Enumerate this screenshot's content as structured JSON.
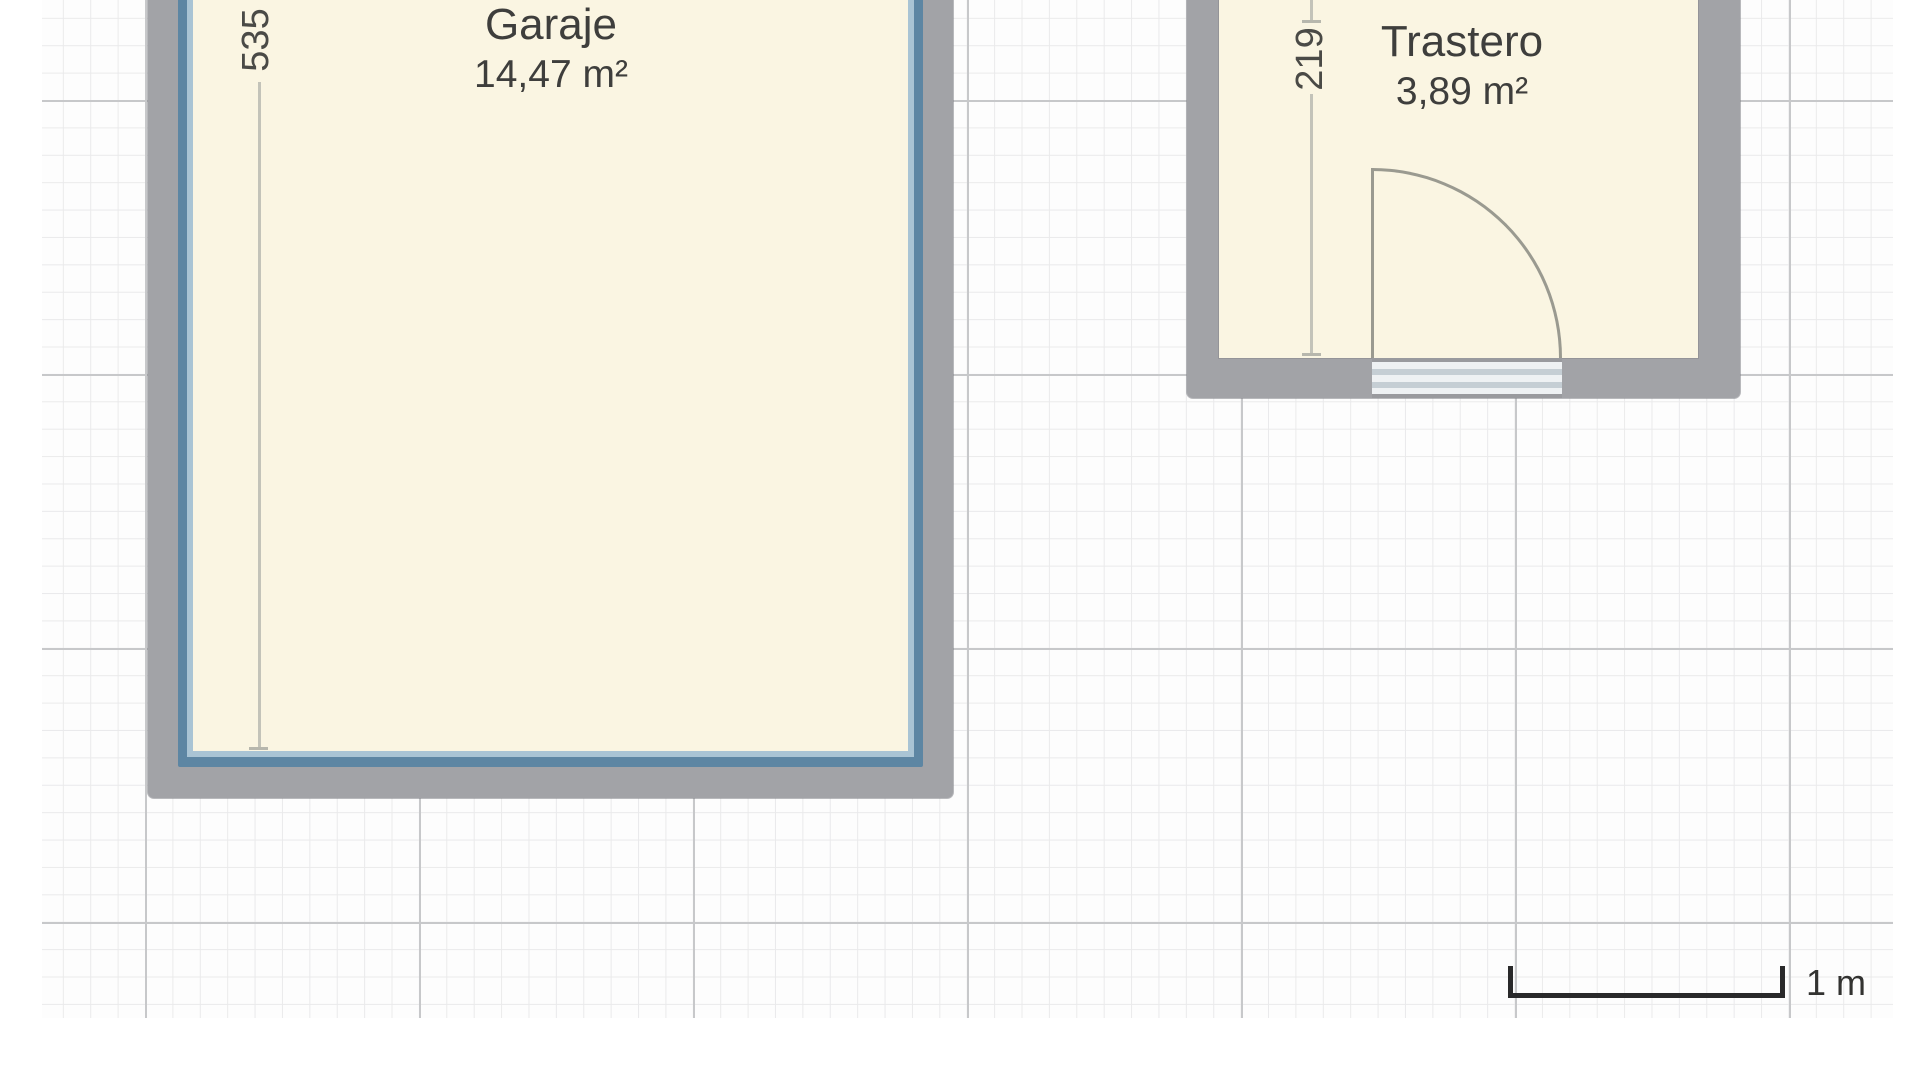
{
  "rooms": [
    {
      "name": "Garaje",
      "area": "14,47 m²",
      "vertical_dimension": "535"
    },
    {
      "name": "Trastero",
      "area": "3,89 m²",
      "vertical_dimension": "219"
    }
  ],
  "scale_bar": {
    "label": "1 m"
  },
  "colors": {
    "room_fill": "#faf5e2",
    "wall_gray": "#a2a3a7",
    "wall_lining_outer_blue": "#5d86a3",
    "wall_lining_inner_blue": "#a9c4d4",
    "grid_minor": "#eaeaeb",
    "grid_major": "#c7c8ca",
    "dimension_line": "#c3c3b9",
    "dimension_text": "#4a4a46",
    "door_stroke": "#9a9a90",
    "threshold_stripe": "#c5ced4",
    "scale_bar": "#29292a",
    "label_text": "#3e3e3c"
  }
}
